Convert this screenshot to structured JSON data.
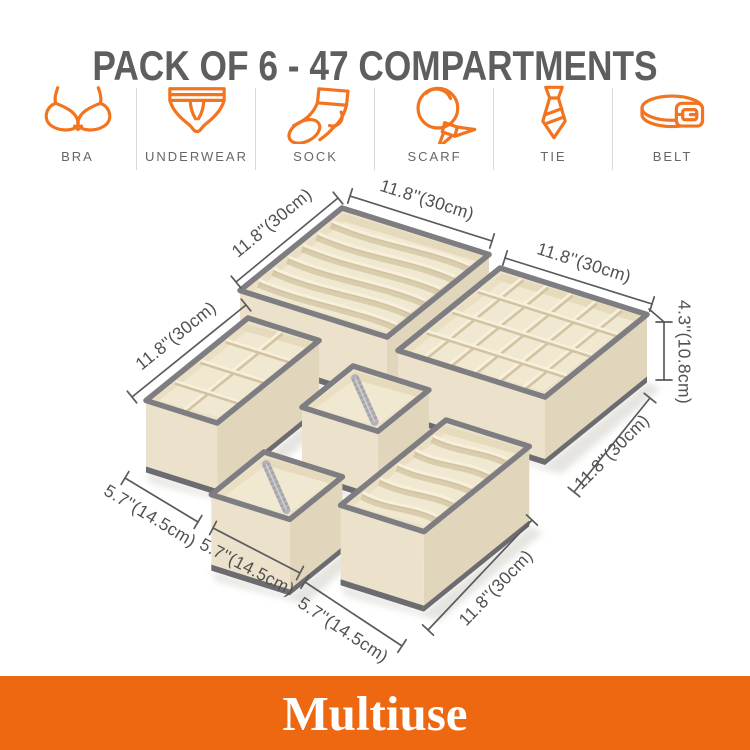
{
  "page": {
    "background": "#ffffff"
  },
  "header": {
    "title": "PACK OF 6 - 47 COMPARTMENTS",
    "color": "#5e5e5e"
  },
  "icon_row": {
    "accent": "#F3741E",
    "label_color": "#676767",
    "items": [
      {
        "id": "bra",
        "label": "BRA"
      },
      {
        "id": "underwear",
        "label": "UNDERWEAR"
      },
      {
        "id": "sock",
        "label": "SOCK"
      },
      {
        "id": "scarf",
        "label": "SCARF"
      },
      {
        "id": "tie",
        "label": "TIE"
      },
      {
        "id": "belt",
        "label": "BELT"
      }
    ]
  },
  "scene": {
    "fabric": {
      "outer": "#ece2cb",
      "outer_dark": "#e1d6bc",
      "interior": "#f1e8d1",
      "slat_light": "#f8f0dc",
      "slat_shadow": "#d2c4a2",
      "trim": "#7d7d82",
      "base": "#6c6c70"
    },
    "total_compartments": 47,
    "boxes": [
      {
        "id": "A",
        "name": "organizer-box-7-slot",
        "compartments": 7
      },
      {
        "id": "B",
        "name": "organizer-box-24-cell",
        "compartments": 24
      },
      {
        "id": "C",
        "name": "organizer-box-8-cell",
        "compartments": 8
      },
      {
        "id": "D",
        "name": "organizer-open-box-small",
        "compartments": 1
      },
      {
        "id": "E",
        "name": "organizer-open-box-small",
        "compartments": 1
      },
      {
        "id": "F",
        "name": "organizer-box-6-slot",
        "compartments": 6
      }
    ],
    "dimensions": [
      {
        "id": "a_left",
        "text": "11.8''(30cm)"
      },
      {
        "id": "a_top",
        "text": "11.8''(30cm)"
      },
      {
        "id": "b_top",
        "text": "11.8''(30cm)"
      },
      {
        "id": "b_height",
        "text": "4.3''(10.8cm)"
      },
      {
        "id": "b_right",
        "text": "11.8''(30cm)"
      },
      {
        "id": "c_left",
        "text": "11.8''(30cm)"
      },
      {
        "id": "c_front",
        "text": "5.7''(14.5cm)"
      },
      {
        "id": "e_front",
        "text": "5.7''(14.5cm)"
      },
      {
        "id": "f_front",
        "text": "5.7''(14.5cm)"
      },
      {
        "id": "f_right",
        "text": "11.8''(30cm)"
      }
    ]
  },
  "banner": {
    "label": "Multiuse",
    "background": "#EE6711",
    "text_color": "#ffffff"
  }
}
